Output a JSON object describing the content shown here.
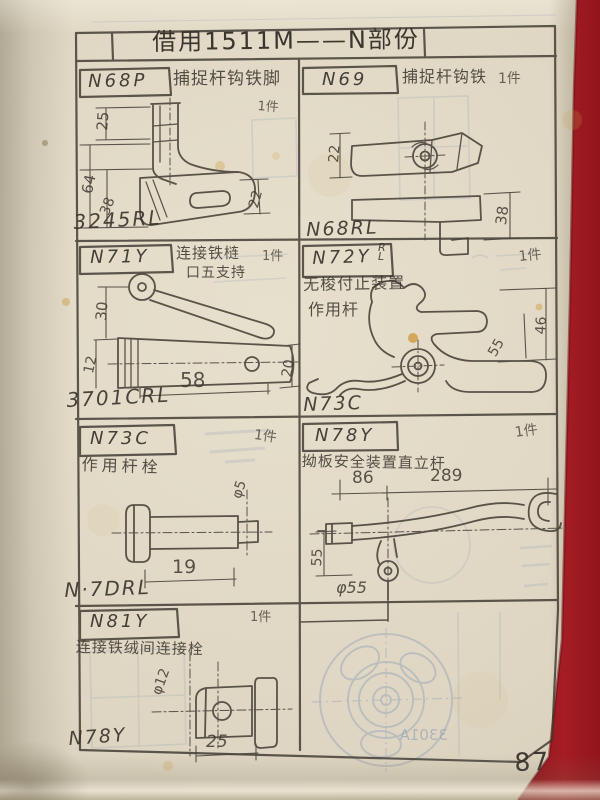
{
  "page": {
    "title": "借用1511M——N部份",
    "page_number": "87",
    "bleed_label": "3301A"
  },
  "cells": {
    "c1": {
      "no": "N68P",
      "desc": "捕捉杆钩铁脚",
      "qty": "1件",
      "label": "3245RL",
      "d1": "25",
      "d2": "64",
      "d3": "38",
      "d4": "22"
    },
    "c2": {
      "no": "N69",
      "desc": "捕捉杆钩铁",
      "qty": "1件",
      "label": "N68RL",
      "d1": "22",
      "d2": "38"
    },
    "c3": {
      "no": "N71Y",
      "desc": "连接铁梿",
      "desc2": "口五支持",
      "qty": "1件",
      "label": "3701CRL",
      "d1": "30",
      "d2": "12",
      "d3": "58",
      "d4": "20"
    },
    "c4": {
      "no": "N72Y",
      "sup": "R",
      "sup2": "L",
      "desc": "无梭付止装置",
      "desc2": "作用杆",
      "qty": "1件",
      "label": "N73C",
      "d1": "55",
      "d2": "46"
    },
    "c5": {
      "no": "N73C",
      "desc": "作用杆栓",
      "qty": "1件",
      "label": "N·7DRL",
      "d1": "φ5",
      "d2": "19"
    },
    "c6": {
      "no": "N78Y",
      "desc": "拗板安全装置直立杆",
      "qty": "1件",
      "d1": "86",
      "d2": "289",
      "d3": "55",
      "d4": "φ55"
    },
    "c7": {
      "no": "N81Y",
      "desc": "连接铁绒间连接栓",
      "qty": "1件",
      "label": "N78Y",
      "d1": "φ12",
      "d2": "25"
    }
  }
}
